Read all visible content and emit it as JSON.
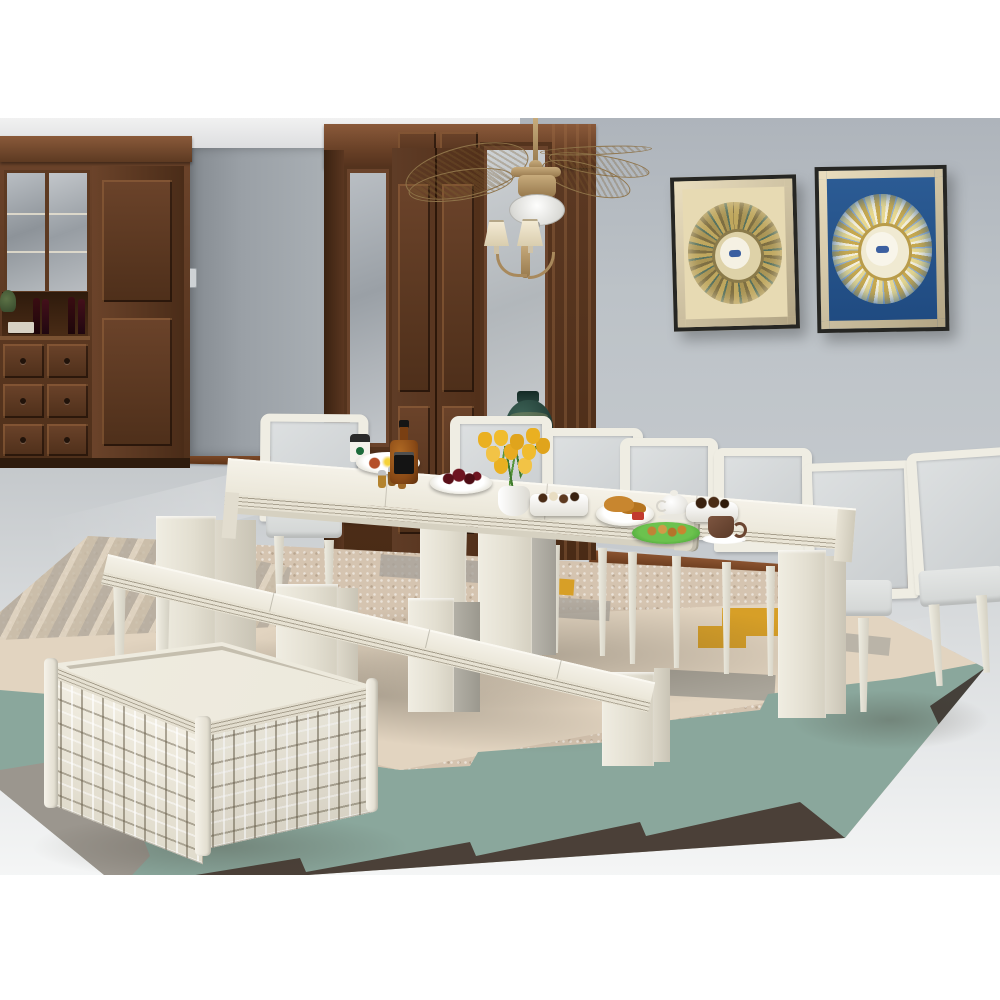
{
  "scene": {
    "description_labels": {
      "room": "dining room",
      "cabinet": "dark brown china cabinet with glass doors and wine bottles",
      "paneled_wall": "dark walnut wall paneling with frosted sidelights",
      "ceiling_fan": "brass ceiling fan with woven palm blades and dome light",
      "wall_sconce": "two-shade brass wall sconce",
      "vase": "dark teal ceramic urn",
      "artwork_gold": "gold mandala artwork in champagne frame",
      "artwork_blue": "blue mandala artwork in champagne frame",
      "dining_table": "linen white extendable dining table",
      "chair": "linen white dining chair with light gray upholstery",
      "bench": "linen white extendable dining bench",
      "trunk": "linen white basket-weave storage trunk coffee table",
      "rug": "geometric stepped kilim rug"
    },
    "counts": {
      "chairs": 7,
      "benches": 1,
      "tables": 1,
      "trunks": 1,
      "artworks": 2
    },
    "food_items": [
      "breakfast plate",
      "coffee to-go cup",
      "shaker set",
      "whiskey bottle",
      "cherries plate",
      "yellow tulips in white vase",
      "chocolates plate",
      "croissant plate",
      "white teapot",
      "small chocolates plate",
      "green cookie plate",
      "brown coffee cup with saucer"
    ],
    "palette": {
      "wall": "#bcc2c7",
      "ceiling": "#ededee",
      "floor": "#d9dcde",
      "wood_dark": "#4e2f1a",
      "wood_mid": "#6b432a",
      "baseboard": "#7a4728",
      "furniture_cream": "#f0ede2",
      "upholstery_gray": "#d3d7d8",
      "brass": "#b6996a",
      "blade_tan": "#c2a477",
      "vase_teal": "#27443c",
      "art_gold": "#bfa75e",
      "art_blue": "#2c5c95",
      "rug_beige": "#d5c4b0",
      "rug_cream_band": "#e2d4c0",
      "rug_teal": "#8aa79c",
      "rug_dark": "#4b4038",
      "rug_gray": "#a7a39b",
      "rug_mustard": "#d79f27",
      "tulip_yellow": "#eab021",
      "plate_green": "#54ae3f"
    }
  }
}
